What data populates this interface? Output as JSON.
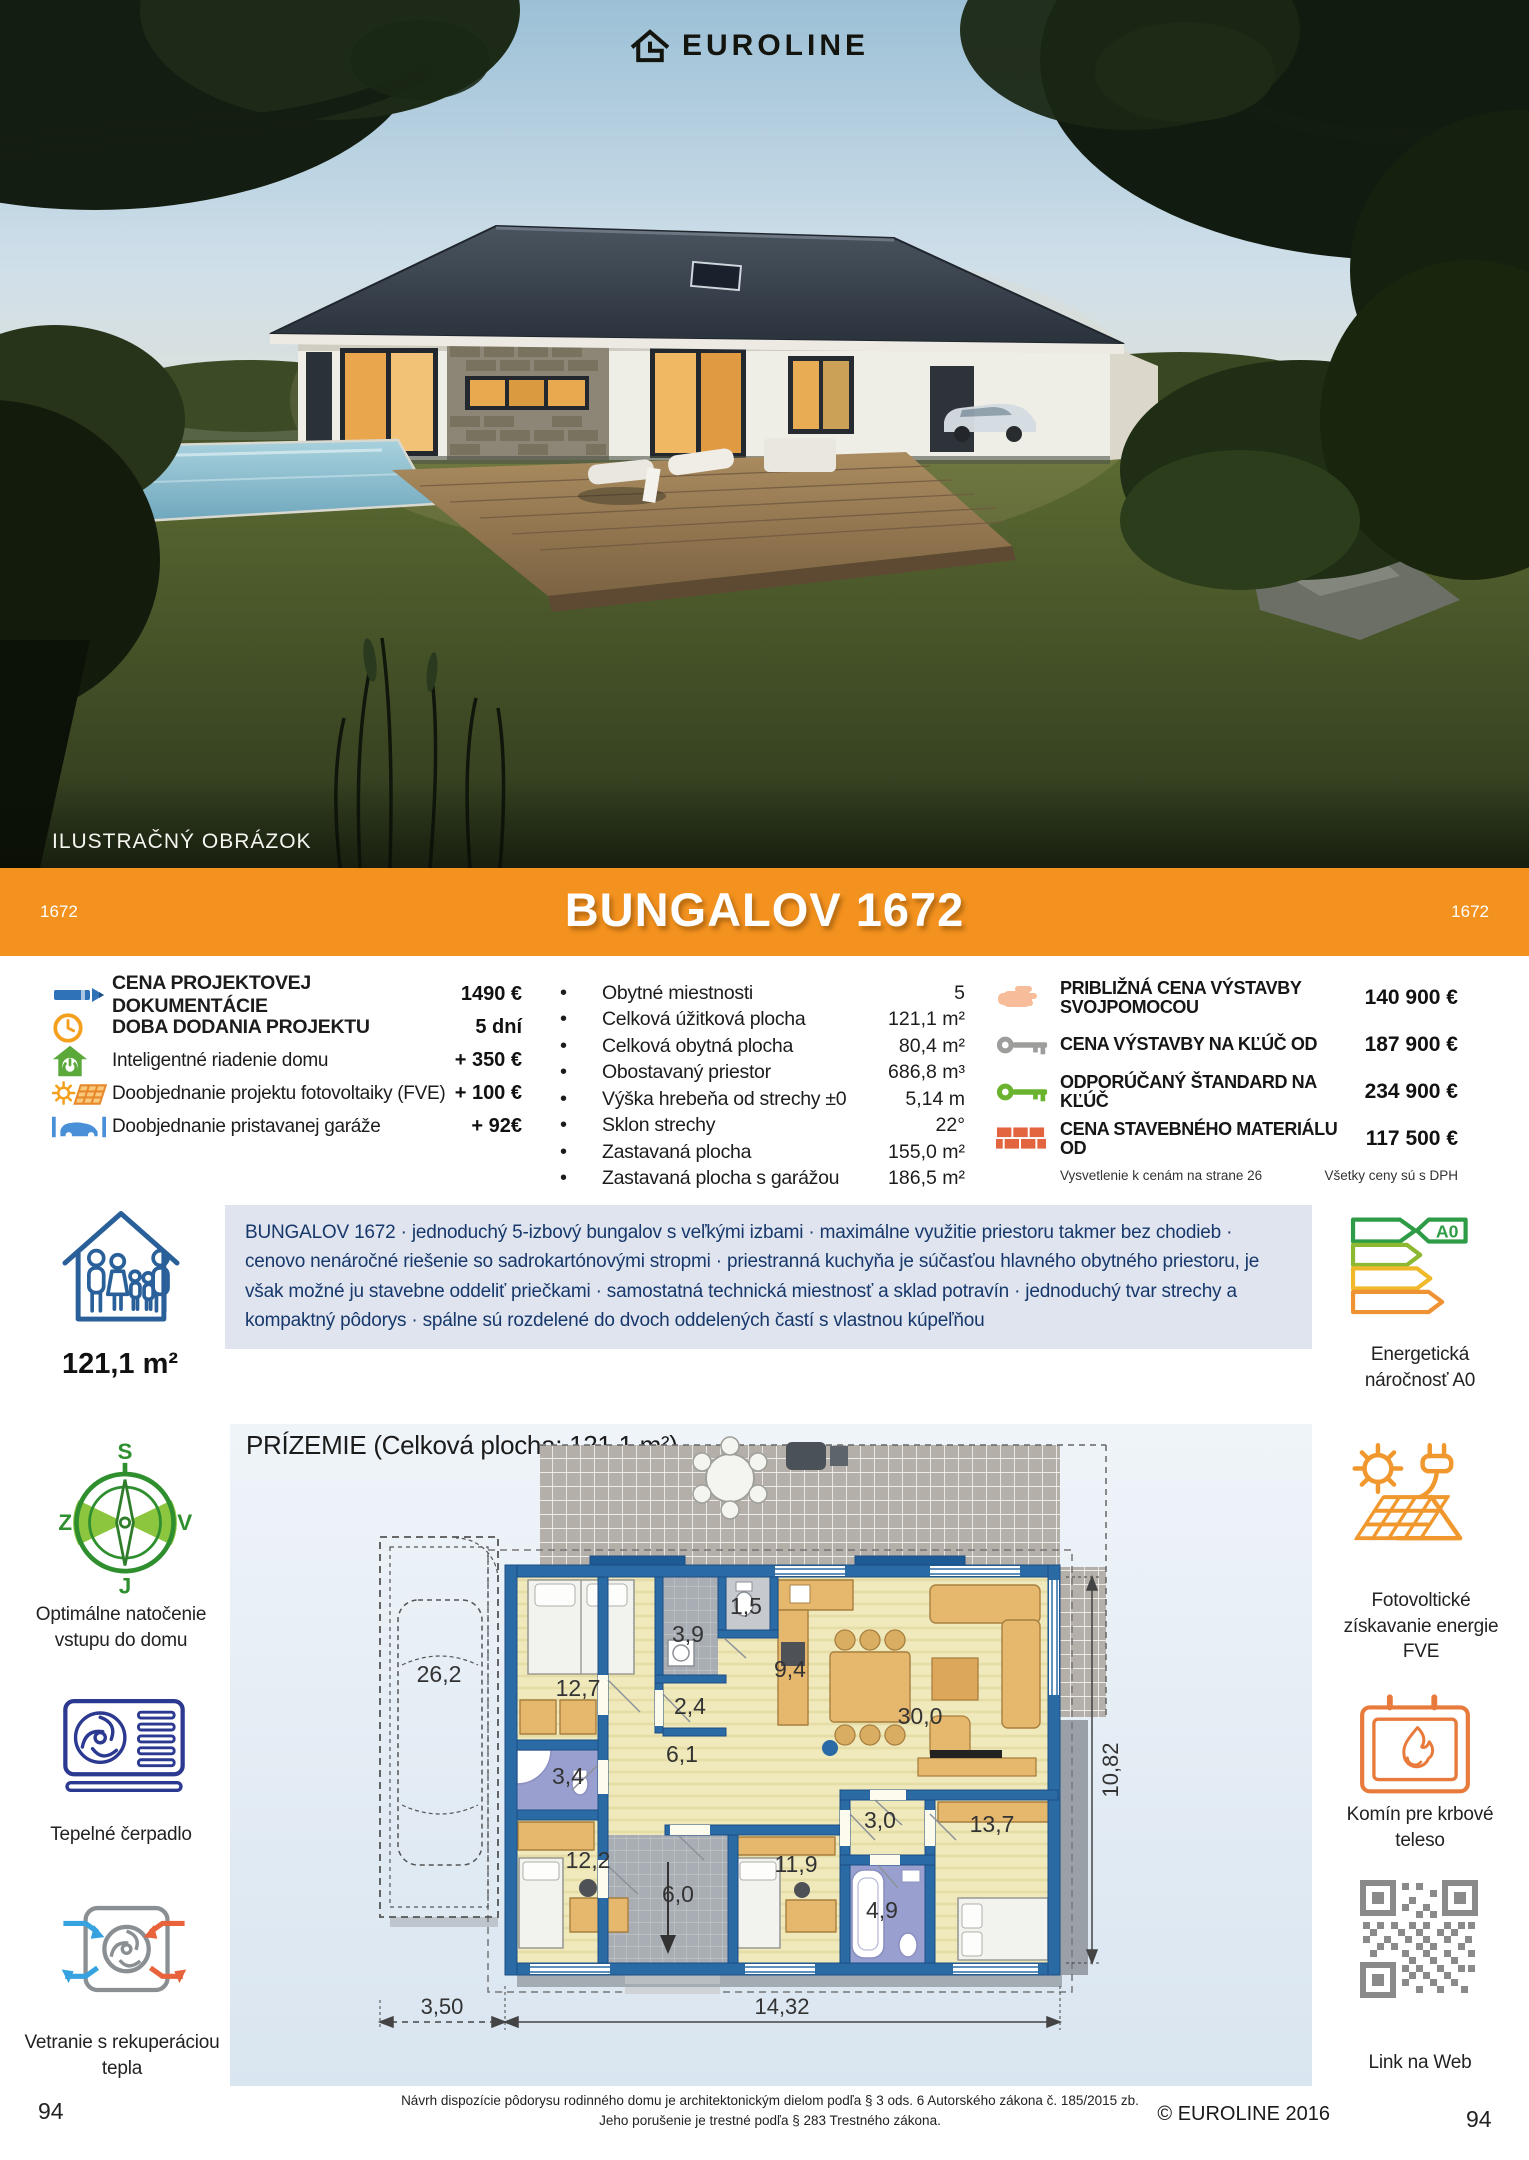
{
  "brand": {
    "name": "EUROLINE"
  },
  "hero": {
    "caption": "ILUSTRAČNÝ OBRÁZOK"
  },
  "banner": {
    "title": "BUNGALOV 1672",
    "code_left": "1672",
    "code_right": "1672",
    "color": "#f4921f"
  },
  "pricing_left": {
    "rows": [
      {
        "icon": "pencil-icon",
        "label": "CENA PROJEKTOVEJ DOKUMENTÁCIE",
        "value": "1490 €"
      },
      {
        "icon": "clock-icon",
        "label": "DOBA DODANIA PROJEKTU",
        "value": "5 dní"
      },
      {
        "icon": "smart-home-icon",
        "label": "Inteligentné riadenie domu",
        "value": "+ 350 €"
      },
      {
        "icon": "solar-icon",
        "label": "Doobjednanie projektu fotovoltaiky (FVE)",
        "value": "+ 100 €"
      },
      {
        "icon": "car-garage-icon",
        "label": "Doobjednanie pristavanej garáže",
        "value": "+ 92€"
      }
    ]
  },
  "specs": {
    "rows": [
      {
        "label": "Obytné miestnosti",
        "value": "5"
      },
      {
        "label": "Celková úžitková plocha",
        "value": "121,1 m²"
      },
      {
        "label": "Celková obytná plocha",
        "value": "80,4 m²"
      },
      {
        "label": "Obostavaný priestor",
        "value": "686,8 m³"
      },
      {
        "label": "Výška hrebeňa od strechy ±0",
        "value": "5,14 m"
      },
      {
        "label": "Sklon strechy",
        "value": "22°"
      },
      {
        "label": "Zastavaná plocha",
        "value": "155,0 m²"
      },
      {
        "label": "Zastavaná plocha s garážou",
        "value": "186,5 m²"
      }
    ]
  },
  "pricing_right": {
    "rows": [
      {
        "icon": "hand-icon",
        "label": "PRIBLIŽNÁ CENA VÝSTAVBY SVOJPOMOCOU",
        "value": "140 900 €"
      },
      {
        "icon": "key-gray-icon",
        "label": "CENA VÝSTAVBY NA KĽÚČ OD",
        "value": "187 900 €"
      },
      {
        "icon": "key-green-icon",
        "label": "ODPORÚČANÝ ŠTANDARD NA KĽÚČ",
        "value": "234 900 €"
      },
      {
        "icon": "bricks-icon",
        "label": "CENA STAVEBNÉHO MATERIÁLU OD",
        "value": "117 500 €"
      }
    ],
    "note_left": "Vysvetlenie k cenám na strane 26",
    "note_right": "Všetky ceny sú s DPH"
  },
  "description": {
    "text": "BUNGALOV 1672 · jednoduchý 5-izbový bungalov s veľkými izbami ·  maximálne využitie priestoru takmer bez chodieb · cenovo nenáročné riešenie so sadrokartónovými stropmi · priestranná kuchyňa je súčasťou hlavného obytného priestoru, je však možné ju stavebne oddeliť priečkami · samostatná technická miestnosť a sklad potravín · jednoduchý tvar strechy a kompaktný pôdorys · spálne sú rozdelené do dvoch oddelených častí s vlastnou kúpeľňou"
  },
  "sidebar_left": {
    "area": "121,1 m²",
    "compass": {
      "n": "S",
      "w": "Z",
      "e": "V",
      "s": "J"
    },
    "compass_label": "Optimálne natočenie vstupu do domu",
    "heatpump_label": "Tepelné čerpadlo",
    "ventilation_label": "Vetranie s rekuperáciou tepla"
  },
  "sidebar_right": {
    "energy_badge": "A0",
    "energy_label": "Energetická náročnosť A0",
    "fve_label": "Fotovoltické získavanie energie FVE",
    "fireplace_label": "Komín pre krbové teleso",
    "qr_label": "Link na Web"
  },
  "floorplan": {
    "heading": "PRÍZEMIE (Celková plocha: 121,1 m²)",
    "rooms": {
      "garage": "26,2",
      "bedroom1": "12,7",
      "tech": "3,9",
      "wc": "1,5",
      "kitchen": "9,4",
      "hall_a": "2,4",
      "hall_b": "6,1",
      "bath1": "3,4",
      "bedroom2": "12,2",
      "living": "30,0",
      "hall_c": "3,0",
      "bedroom3": "11,9",
      "entry": "6,0",
      "bath2": "4,9",
      "bedroom4": "13,7"
    },
    "dims": {
      "garage_width": "3,50",
      "house_width": "14,32",
      "house_depth": "10,82"
    }
  },
  "footer": {
    "disclaimer1": "Návrh dispozície pôdorysu rodinného domu je architektonickým dielom podľa § 3 ods. 6 Autorského zákona č. 185/2015 zb.",
    "disclaimer2": "Jeho porušenie je trestné podľa § 283 Trestného zákona.",
    "copyright": "© EUROLINE 2016",
    "page_left": "94",
    "page_right": "94"
  }
}
